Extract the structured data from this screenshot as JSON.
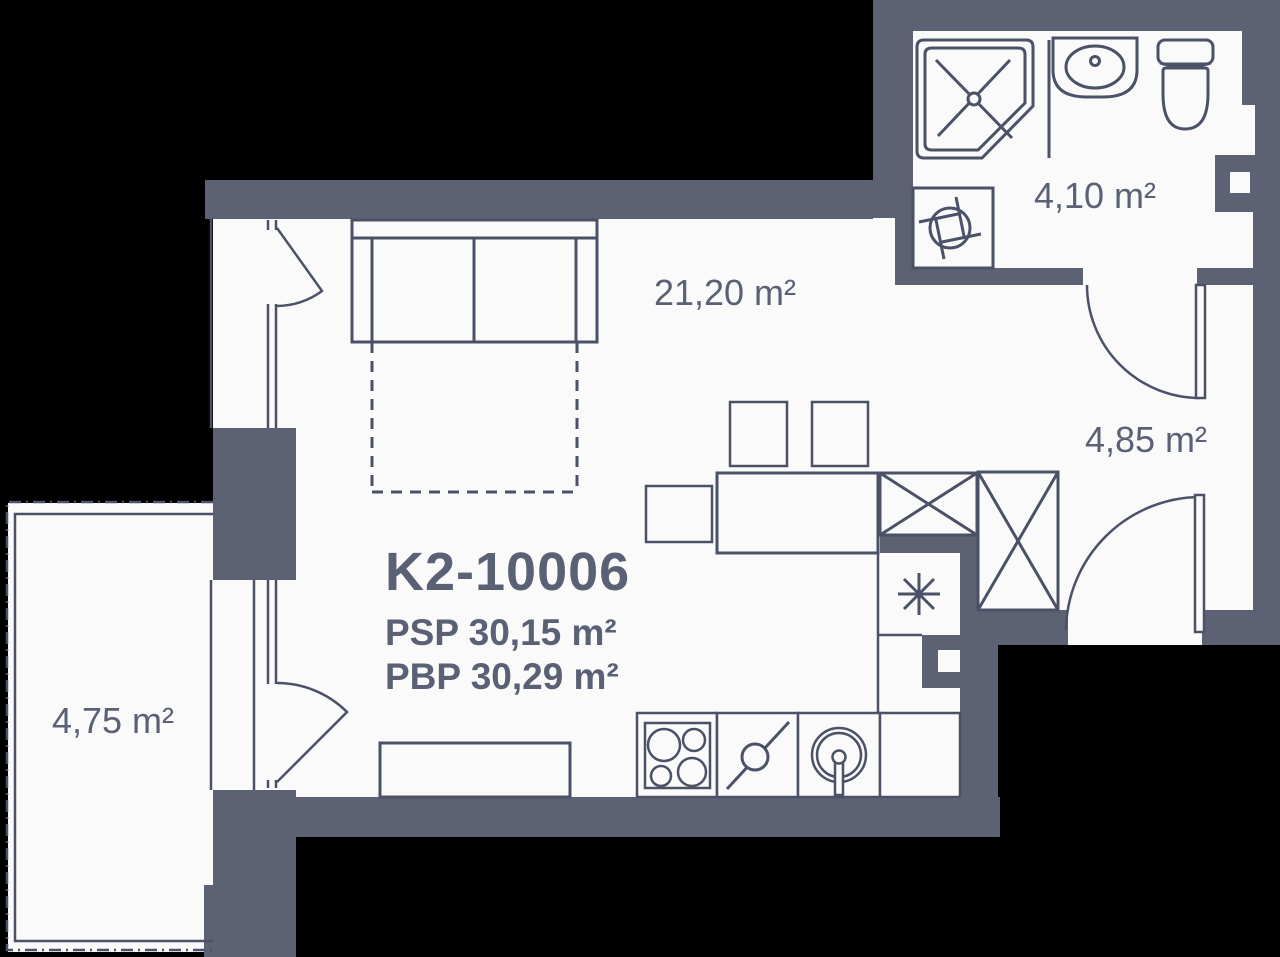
{
  "plan": {
    "title": "K2-10006",
    "psp": "PSP 30,15 m²",
    "pbp": "PBP 30,29 m²",
    "rooms": [
      {
        "name": "living-kitchen",
        "area": "21,20 m²"
      },
      {
        "name": "bathroom",
        "area": "4,10 m²"
      },
      {
        "name": "hallway",
        "area": "4,85 m²"
      },
      {
        "name": "balcony",
        "area": "4,75 m²"
      }
    ],
    "colors": {
      "wall": "#5C6274",
      "line": "#4B5267",
      "text": "#5B6175",
      "floor": "#FAFAFB",
      "background": "#000000"
    }
  }
}
